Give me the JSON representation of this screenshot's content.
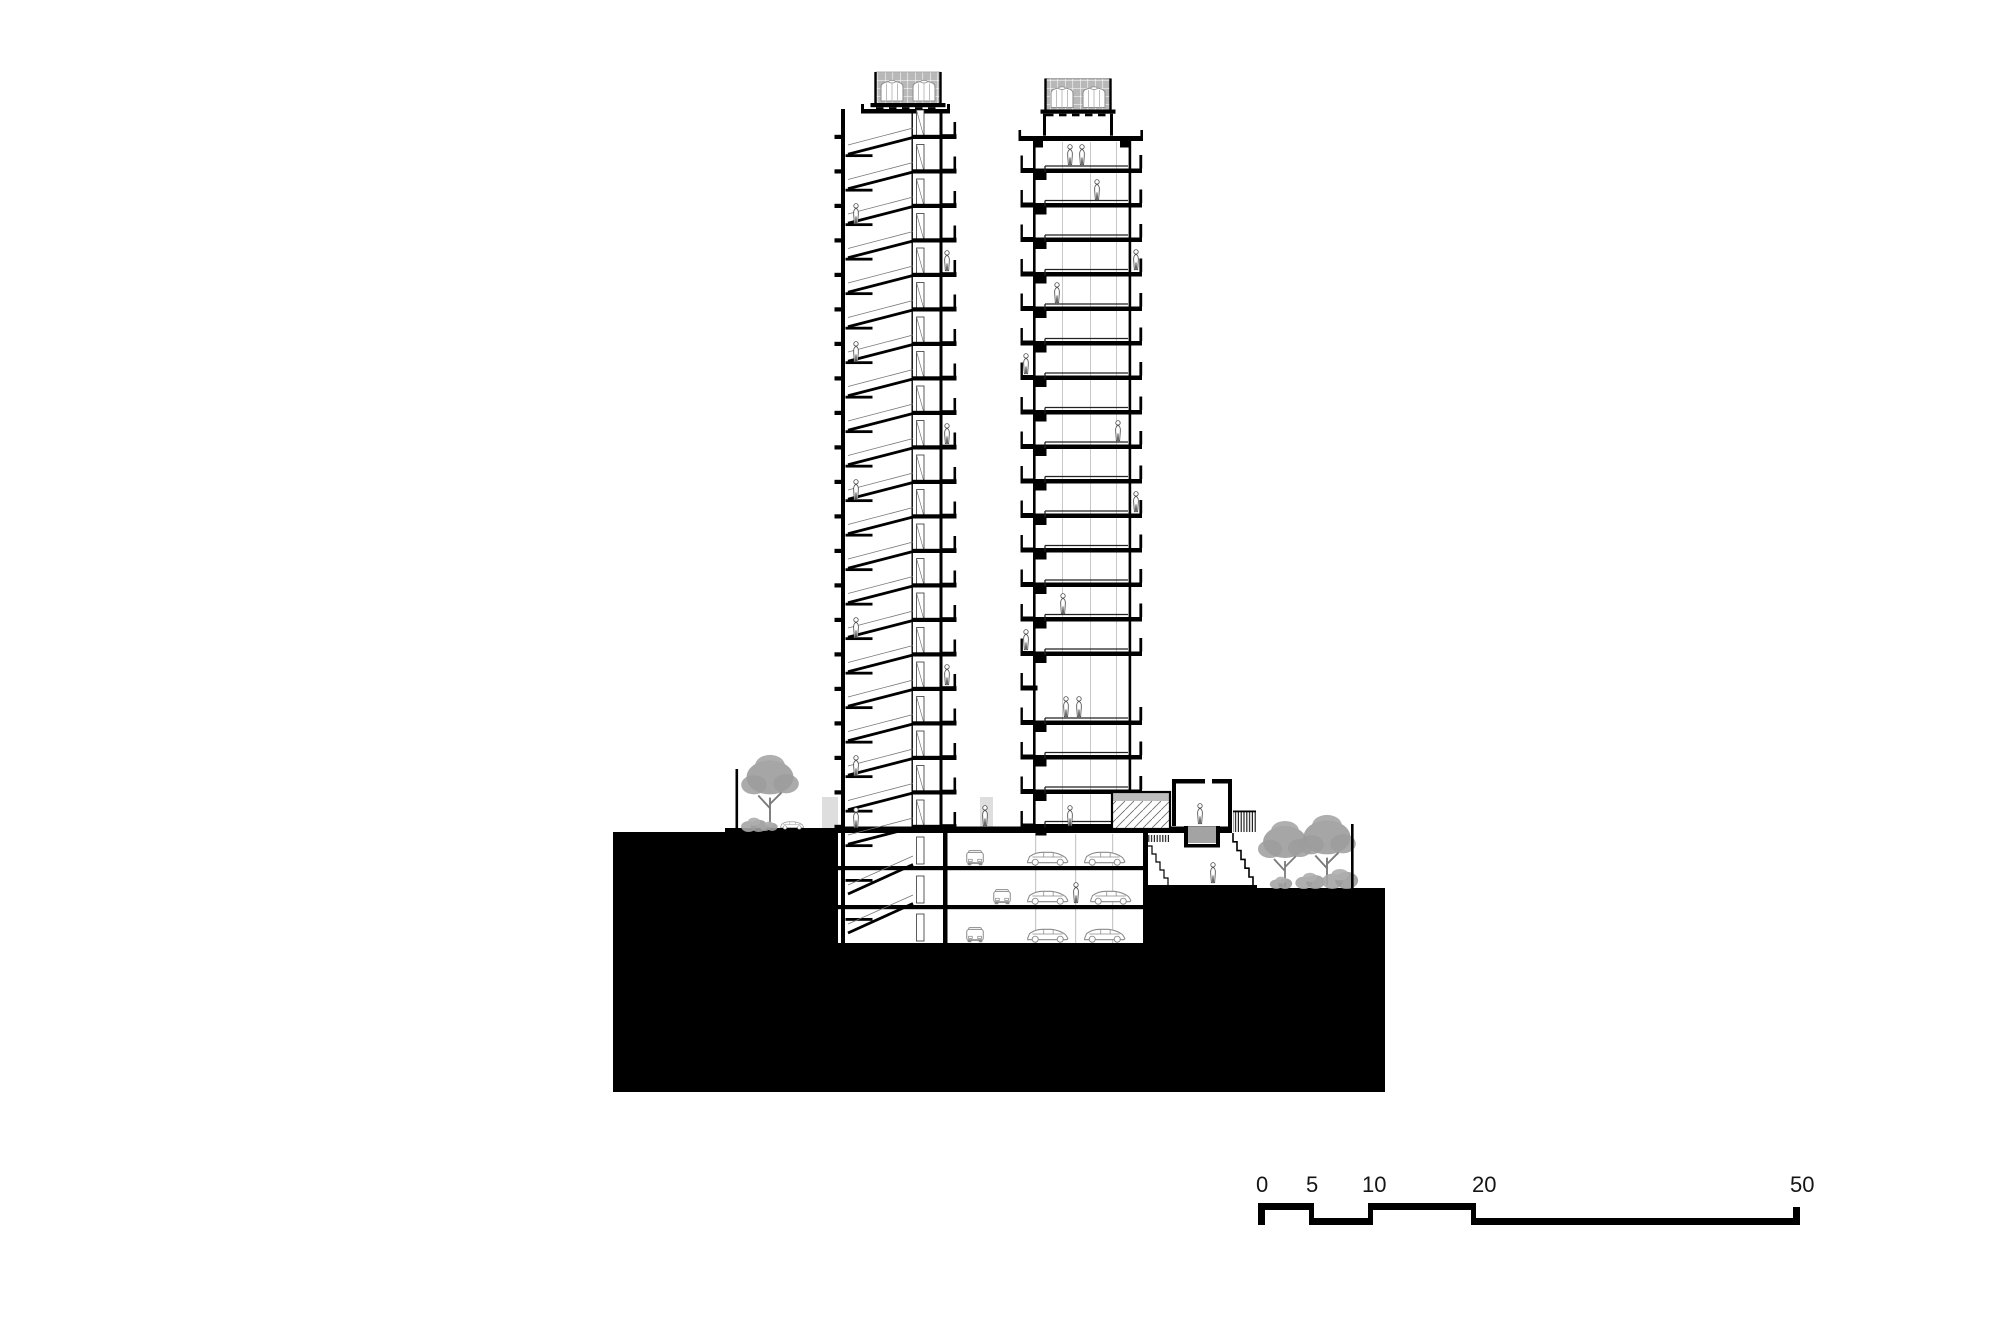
{
  "sheet": {
    "width": 2000,
    "height": 1333,
    "background": "#ffffff",
    "description": "architectural cross section of twin residential towers over a parking podium"
  },
  "palette": {
    "ink": "#000000",
    "wall_gray": "#4a4a4a",
    "entourage_gray": "#9c9c9c",
    "trunk_gray": "#7b7b7b",
    "car_gray": "#8a8a8a",
    "screen_gray": "#b8b8b8",
    "court_gray": "#a3a3a3",
    "glass_cap_gray": "#bcbcbc",
    "mullion_gray": "#c9c9c9",
    "backwall_gray": "#dedede"
  },
  "section": {
    "left_tower": {
      "stories_above_ground": 21,
      "basement_levels": 3,
      "roof_tanks": 2,
      "has_scissor_stair": true,
      "x_left": 841,
      "x_right": 943,
      "roof_y": 109,
      "first_floor_y": 139,
      "floor_height": 34.5,
      "ground_y": 830
    },
    "right_tower": {
      "stories_above_ground": 20,
      "roof_tanks": 2,
      "sky_garden_skip_index": 15,
      "x_left": 1033,
      "x_right": 1131,
      "roof_y": 136,
      "first_floor_y": 173,
      "floor_height": 34.5,
      "ground_y": 830
    },
    "parking": {
      "levels": 3,
      "slab_ys": [
        866,
        905,
        943
      ],
      "cars_side": [
        [
          1024,
          866
        ],
        [
          1081,
          866
        ],
        [
          1024,
          905
        ],
        [
          1087,
          905
        ],
        [
          1024,
          943
        ],
        [
          1081,
          943
        ]
      ],
      "cars_front": [
        [
          964,
          866
        ],
        [
          991,
          905
        ],
        [
          964,
          943
        ]
      ],
      "columns_x": [
        1035,
        1075,
        1112
      ]
    },
    "masses": {
      "terrace_block": [
        613,
        832,
        225,
        260
      ],
      "terrace_step": [
        725,
        828,
        113,
        6
      ],
      "podium_block": [
        838,
        943,
        547,
        149
      ],
      "garden_block": [
        1145,
        888,
        240,
        204
      ],
      "ground_slab": [
        838,
        826.5,
        394,
        6.5
      ],
      "parking_left_wall": [
        943,
        833,
        4.5,
        110
      ],
      "room_wall": [
        1143,
        833,
        5,
        110
      ]
    },
    "pavilion": {
      "x": 1172,
      "roof_y": 779,
      "court": [
        1184,
        826,
        36,
        20
      ],
      "has_sunken_court": true
    },
    "glass_box": [
      1112,
      792,
      58,
      37
    ],
    "figures": [
      [
        856,
        225
      ],
      [
        856,
        363
      ],
      [
        856,
        501
      ],
      [
        856,
        639
      ],
      [
        856,
        777
      ],
      [
        947,
        272
      ],
      [
        947,
        445
      ],
      [
        947,
        686
      ],
      [
        856,
        829
      ],
      [
        985,
        827
      ],
      [
        1070,
        827
      ],
      [
        1200,
        825
      ],
      [
        1213,
        884
      ],
      [
        1076,
        904
      ],
      [
        1097,
        201
      ],
      [
        1057,
        304
      ],
      [
        1118,
        442
      ],
      [
        1063,
        615
      ],
      [
        1070,
        166
      ],
      [
        1082,
        166
      ],
      [
        1066,
        718
      ],
      [
        1079,
        718
      ],
      [
        1026,
        651
      ],
      [
        1026,
        375
      ],
      [
        1136,
        271
      ],
      [
        1136,
        513
      ]
    ],
    "trees": [
      [
        738,
        745,
        64,
        86
      ],
      [
        1255,
        814,
        60,
        76
      ],
      [
        1295,
        806,
        64,
        84
      ]
    ],
    "shrubs": [
      [
        737,
        817,
        34,
        15
      ],
      [
        756,
        821,
        26,
        10
      ],
      [
        1290,
        872,
        40,
        17
      ],
      [
        1318,
        868,
        44,
        21
      ],
      [
        1266,
        876,
        30,
        13
      ]
    ],
    "fence_posts": [
      [
        735.5,
        769,
        2.6,
        61
      ],
      [
        1351,
        824,
        2.6,
        65
      ]
    ],
    "car_at_grade": [
      779,
      830
    ],
    "back_walls": [
      [
        822,
        797,
        16,
        31
      ],
      [
        980,
        797,
        13,
        31
      ]
    ]
  },
  "scale_bar": {
    "unit": "meters",
    "x0": 1260,
    "px_per_m": 10.8,
    "bar_top_y": 1203,
    "bar_bot_y": 1225,
    "label_top_y": 1174,
    "unit_marks": [
      {
        "text": "0",
        "m": 0,
        "x": 1256
      },
      {
        "text": "5",
        "m": 5,
        "x": 1306
      },
      {
        "text": "10",
        "m": 10,
        "x": 1362
      },
      {
        "text": "20",
        "m": 20,
        "x": 1472
      },
      {
        "text": "50",
        "m": 50,
        "x": 1790
      }
    ]
  }
}
